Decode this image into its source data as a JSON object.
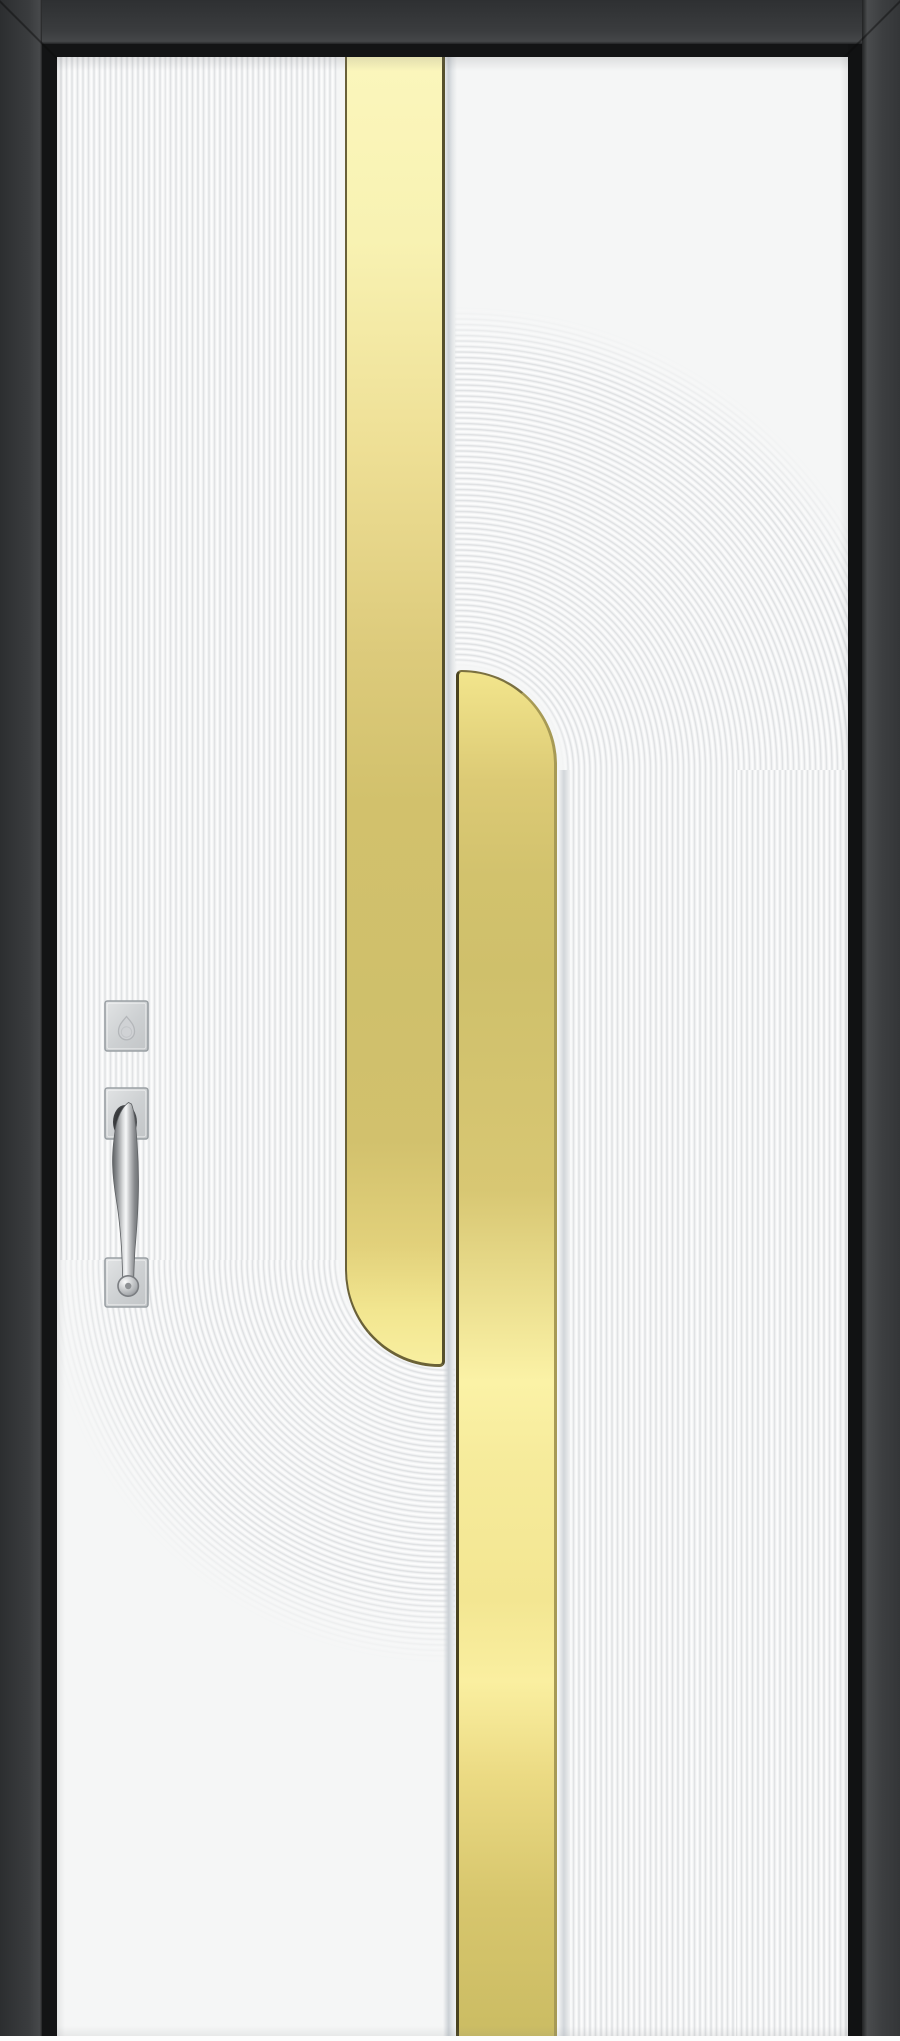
{
  "scene": {
    "subject": "modern-entry-door",
    "view": "front-elevation"
  },
  "door": {
    "frame": {
      "face_color": "#37393b",
      "inner_band_color": "#141517",
      "corner_joint": "mitred"
    },
    "panel": {
      "base_color": "#f5f6f6",
      "ridge_highlight": "#fefefe",
      "ridge_shadow": "#dcdee0",
      "ridge_pitch_px": 5.5
    },
    "gold_inlays": {
      "pale_tone": "#fbf6bc",
      "deep_tone": "#cfc06b",
      "bright_tone": "#fcf3a8",
      "edge_line_color": "#5e5630",
      "left_bar": {
        "end_style": "rounded-bottom-left"
      },
      "right_bar": {
        "end_style": "rounded-top-right"
      }
    },
    "patterns": {
      "left": "fluted-panel-curving-into-U",
      "right": "concentric-arch-over-vertical-flutes"
    },
    "hardware": {
      "finish_color": "#d0d3d5",
      "deadbolt_label": "deadbolt-escutcheon",
      "handle_label": "pull-handle"
    }
  }
}
